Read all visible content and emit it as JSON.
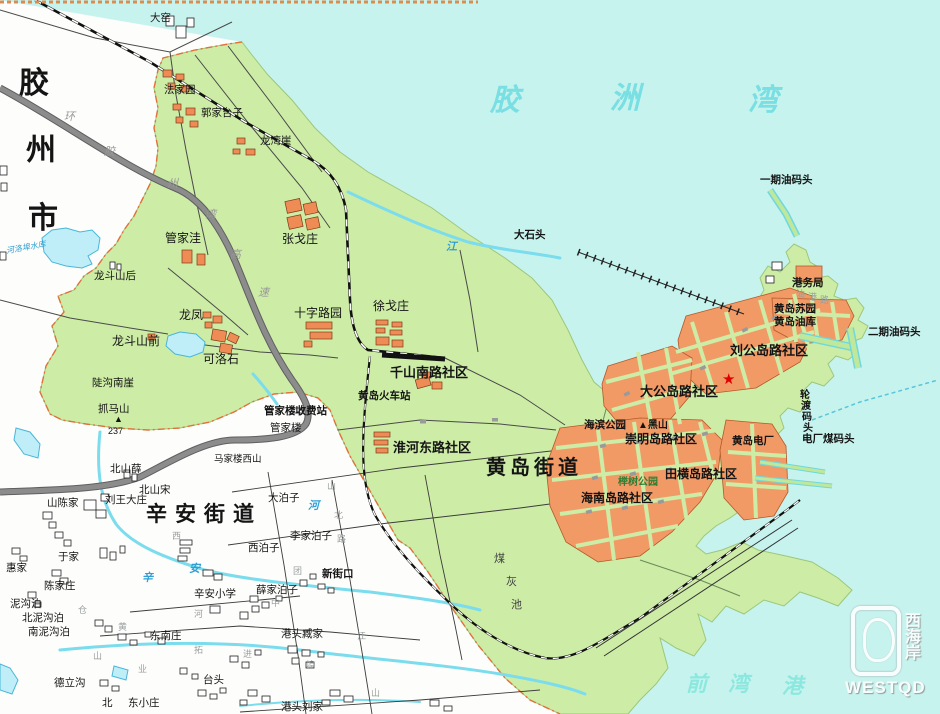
{
  "watermark": {
    "brand": "WESTQD",
    "cn_vertical": "西海岸"
  },
  "legend_colors": {
    "water": "#c7f3ef",
    "rural_land": "#ffffff",
    "district_green": "#cdeca6",
    "urban_orange": "#f29a66",
    "boundary_dash": "#e2703a",
    "highway_gray": "#8c8c8c",
    "river_cyan": "#7adced",
    "star_red": "#e00000"
  },
  "map": {
    "labels": [
      {
        "t": "胶",
        "x": 19,
        "y": 69,
        "c": "city"
      },
      {
        "t": "州",
        "x": 26,
        "y": 136,
        "c": "city"
      },
      {
        "t": "市",
        "x": 28,
        "y": 204,
        "c": "city"
      },
      {
        "t": "胶",
        "x": 490,
        "y": 86,
        "c": "bay"
      },
      {
        "t": "洲",
        "x": 610,
        "y": 84,
        "c": "bay"
      },
      {
        "t": "湾",
        "x": 748,
        "y": 86,
        "c": "bay"
      },
      {
        "t": "前",
        "x": 686,
        "y": 674,
        "c": "qw"
      },
      {
        "t": "湾",
        "x": 728,
        "y": 674,
        "c": "qw"
      },
      {
        "t": "港",
        "x": 782,
        "y": 676,
        "c": "qw"
      },
      {
        "t": "黄岛街道",
        "x": 486,
        "y": 458,
        "c": "title",
        "ls": 4
      },
      {
        "t": "辛安街道",
        "x": 146,
        "y": 504,
        "c": "title",
        "ls": 8,
        "fs": 21
      },
      {
        "t": "刘公岛路社区",
        "x": 730,
        "y": 344,
        "c": "comm"
      },
      {
        "t": "大公岛路社区",
        "x": 640,
        "y": 385,
        "c": "comm"
      },
      {
        "t": "崇明岛路社区",
        "x": 625,
        "y": 433,
        "c": "comm",
        "fs": 12
      },
      {
        "t": "田横岛路社区",
        "x": 665,
        "y": 468,
        "c": "comm",
        "fs": 12
      },
      {
        "t": "海南岛路社区",
        "x": 581,
        "y": 492,
        "c": "comm",
        "fs": 12
      },
      {
        "t": "淮河东路社区",
        "x": 393,
        "y": 441,
        "c": "comm"
      },
      {
        "t": "千山南路社区",
        "x": 390,
        "y": 366,
        "c": "comm"
      },
      {
        "t": "黄岛苏园",
        "x": 774,
        "y": 304,
        "c": "poi"
      },
      {
        "t": "黄岛油库",
        "x": 774,
        "y": 317,
        "c": "poi"
      },
      {
        "t": "港务局",
        "x": 792,
        "y": 278,
        "c": "poi"
      },
      {
        "t": "海滨公园",
        "x": 584,
        "y": 420,
        "c": "poi"
      },
      {
        "t": "黄岛电厂",
        "x": 732,
        "y": 436,
        "c": "poi"
      },
      {
        "t": "黄岛火车站",
        "x": 358,
        "y": 391,
        "c": "poi"
      },
      {
        "t": "管家楼收费站",
        "x": 264,
        "y": 406,
        "c": "poi"
      },
      {
        "t": "新街口",
        "x": 322,
        "y": 569,
        "c": "poi"
      },
      {
        "t": "大石头",
        "x": 514,
        "y": 230,
        "c": "poi"
      },
      {
        "t": "一期油码头",
        "x": 760,
        "y": 175,
        "c": "poi"
      },
      {
        "t": "二期油码头",
        "x": 868,
        "y": 327,
        "c": "poi"
      },
      {
        "t": "电厂煤码头",
        "x": 802,
        "y": 434,
        "c": "poi"
      },
      {
        "t": "▲黑山",
        "x": 638,
        "y": 421,
        "c": "poi",
        "fs": 10
      },
      {
        "t": "榉树公园",
        "x": 618,
        "y": 478,
        "c": "park"
      },
      {
        "t": "轮",
        "x": 800,
        "y": 391,
        "c": "wharfv"
      },
      {
        "t": "渡",
        "x": 801,
        "y": 402,
        "c": "wharfv"
      },
      {
        "t": "码",
        "x": 802,
        "y": 413,
        "c": "wharfv"
      },
      {
        "t": "头",
        "x": 803,
        "y": 424,
        "c": "wharfv"
      },
      {
        "t": "煤",
        "x": 494,
        "y": 554,
        "c": "coal"
      },
      {
        "t": "灰",
        "x": 506,
        "y": 577,
        "c": "coal"
      },
      {
        "t": "池",
        "x": 511,
        "y": 600,
        "c": "coal"
      },
      {
        "t": "大窑",
        "x": 150,
        "y": 13,
        "c": "vill"
      },
      {
        "t": "法家园",
        "x": 164,
        "y": 85,
        "c": "vill"
      },
      {
        "t": "郭家台子",
        "x": 201,
        "y": 108,
        "c": "vill"
      },
      {
        "t": "龙湾崖",
        "x": 260,
        "y": 136,
        "c": "vill"
      },
      {
        "t": "管家洼",
        "x": 165,
        "y": 232,
        "c": "vill",
        "fs": 12
      },
      {
        "t": "张戈庄",
        "x": 282,
        "y": 233,
        "c": "vill",
        "fs": 12
      },
      {
        "t": "龙斗山后",
        "x": 94,
        "y": 271,
        "c": "vill"
      },
      {
        "t": "龙凤",
        "x": 179,
        "y": 309,
        "c": "vill",
        "fs": 12
      },
      {
        "t": "十字路园",
        "x": 294,
        "y": 307,
        "c": "vill",
        "fs": 12
      },
      {
        "t": "徐戈庄",
        "x": 373,
        "y": 300,
        "c": "vill",
        "fs": 12
      },
      {
        "t": "龙斗山前",
        "x": 112,
        "y": 335,
        "c": "vill",
        "fs": 12
      },
      {
        "t": "可洛石",
        "x": 203,
        "y": 353,
        "c": "vill",
        "fs": 12
      },
      {
        "t": "陡沟南崖",
        "x": 92,
        "y": 378,
        "c": "vill"
      },
      {
        "t": "抓马山",
        "x": 98,
        "y": 404,
        "c": "vill"
      },
      {
        "t": "▲",
        "x": 114,
        "y": 415,
        "c": "elev"
      },
      {
        "t": "237",
        "x": 108,
        "y": 427,
        "c": "elev"
      },
      {
        "t": "北山薛",
        "x": 110,
        "y": 464,
        "c": "vill"
      },
      {
        "t": "北山宋",
        "x": 139,
        "y": 485,
        "c": "vill"
      },
      {
        "t": "山陈家",
        "x": 47,
        "y": 498,
        "c": "vill"
      },
      {
        "t": "刘王大庄",
        "x": 105,
        "y": 495,
        "c": "vill"
      },
      {
        "t": "马家楼西山",
        "x": 214,
        "y": 455,
        "c": "vill",
        "fs": 9.5
      },
      {
        "t": "管家楼",
        "x": 270,
        "y": 423,
        "c": "vill"
      },
      {
        "t": "辛安小学",
        "x": 194,
        "y": 589,
        "c": "vill"
      },
      {
        "t": "于家",
        "x": 58,
        "y": 552,
        "c": "vill"
      },
      {
        "t": "惠家",
        "x": 6,
        "y": 563,
        "c": "vill"
      },
      {
        "t": "陈家庄",
        "x": 44,
        "y": 581,
        "c": "vill"
      },
      {
        "t": "泥沟泊",
        "x": 10,
        "y": 599,
        "c": "vill"
      },
      {
        "t": "北泥沟泊",
        "x": 22,
        "y": 613,
        "c": "vill"
      },
      {
        "t": "南泥沟泊",
        "x": 28,
        "y": 627,
        "c": "vill"
      },
      {
        "t": "德立沟",
        "x": 54,
        "y": 678,
        "c": "vill"
      },
      {
        "t": "东南庄",
        "x": 150,
        "y": 631,
        "c": "vill"
      },
      {
        "t": "台头",
        "x": 203,
        "y": 675,
        "c": "vill"
      },
      {
        "t": "北",
        "x": 102,
        "y": 698,
        "c": "vill"
      },
      {
        "t": "东小庄",
        "x": 128,
        "y": 698,
        "c": "vill"
      },
      {
        "t": "港头臧家",
        "x": 281,
        "y": 629,
        "c": "vill"
      },
      {
        "t": "港头刘家",
        "x": 281,
        "y": 702,
        "c": "vill"
      },
      {
        "t": "大泊子",
        "x": 268,
        "y": 493,
        "c": "vill"
      },
      {
        "t": "李家泊子",
        "x": 290,
        "y": 531,
        "c": "vill"
      },
      {
        "t": "西泊子",
        "x": 248,
        "y": 543,
        "c": "vill"
      },
      {
        "t": "薛家泊子",
        "x": 256,
        "y": 585,
        "c": "vill"
      },
      {
        "t": "河洛埠水库",
        "x": 6,
        "y": 244,
        "c": "resv",
        "r": -10
      },
      {
        "t": "江",
        "x": 446,
        "y": 242,
        "c": "river"
      },
      {
        "t": "辛",
        "x": 142,
        "y": 573,
        "c": "river"
      },
      {
        "t": "安",
        "x": 189,
        "y": 564,
        "c": "river"
      },
      {
        "t": "河",
        "x": 308,
        "y": 501,
        "c": "river"
      },
      {
        "t": "环",
        "x": 64,
        "y": 112,
        "c": "roadlbl"
      },
      {
        "t": "胶",
        "x": 104,
        "y": 147,
        "c": "roadlbl"
      },
      {
        "t": "州",
        "x": 167,
        "y": 179,
        "c": "roadlbl"
      },
      {
        "t": "湾",
        "x": 205,
        "y": 210,
        "c": "roadlbl"
      },
      {
        "t": "高",
        "x": 230,
        "y": 250,
        "c": "roadlbl"
      },
      {
        "t": "速",
        "x": 258,
        "y": 288,
        "c": "roadlbl"
      },
      {
        "t": "油",
        "x": 796,
        "y": 290,
        "c": "street"
      },
      {
        "t": "港",
        "x": 808,
        "y": 293,
        "c": "street"
      },
      {
        "t": "路",
        "x": 820,
        "y": 296,
        "c": "street"
      },
      {
        "t": "山",
        "x": 327,
        "y": 482,
        "c": "street"
      },
      {
        "t": "北",
        "x": 334,
        "y": 511,
        "c": "street"
      },
      {
        "t": "路",
        "x": 337,
        "y": 535,
        "c": "street"
      },
      {
        "t": "江",
        "x": 357,
        "y": 632,
        "c": "street"
      },
      {
        "t": "山",
        "x": 371,
        "y": 689,
        "c": "street"
      },
      {
        "t": "团",
        "x": 293,
        "y": 567,
        "c": "street"
      },
      {
        "t": "中",
        "x": 271,
        "y": 599,
        "c": "street"
      },
      {
        "t": "西",
        "x": 172,
        "y": 532,
        "c": "street"
      },
      {
        "t": "仓",
        "x": 78,
        "y": 606,
        "c": "street"
      },
      {
        "t": "黄",
        "x": 118,
        "y": 623,
        "c": "street"
      },
      {
        "t": "山",
        "x": 93,
        "y": 652,
        "c": "street"
      },
      {
        "t": "业",
        "x": 138,
        "y": 665,
        "c": "street"
      },
      {
        "t": "拓",
        "x": 194,
        "y": 646,
        "c": "street"
      },
      {
        "t": "进",
        "x": 243,
        "y": 650,
        "c": "street"
      },
      {
        "t": "埠",
        "x": 306,
        "y": 661,
        "c": "street"
      },
      {
        "t": "河",
        "x": 194,
        "y": 610,
        "c": "street"
      },
      {
        "t": "★",
        "x": 722,
        "y": 372,
        "c": "star"
      }
    ]
  }
}
